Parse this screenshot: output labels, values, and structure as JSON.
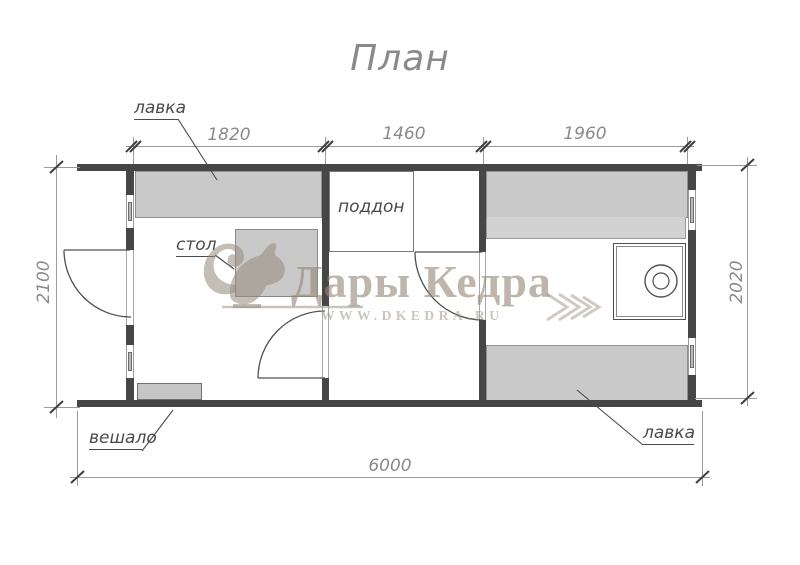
{
  "title": "План",
  "labels": {
    "bench_top": "лавка",
    "table": "стол",
    "tray": "поддон",
    "hanger": "вешало",
    "bench_bottom": "лавка"
  },
  "dimensions": {
    "top": [
      "1820",
      "1460",
      "1960"
    ],
    "left": "2100",
    "right": "2020",
    "bottom": "6000"
  },
  "watermark": {
    "brand": "Дары Кедра",
    "site": "WWW.DKEDRA.RU",
    "logo": "squirrel-icon"
  },
  "colors": {
    "wall": "#464646",
    "bench_fill": "#c9c9c9",
    "line": "#4f4f4f",
    "dim_text": "#8a8a8a",
    "watermark": "#968a7a"
  }
}
